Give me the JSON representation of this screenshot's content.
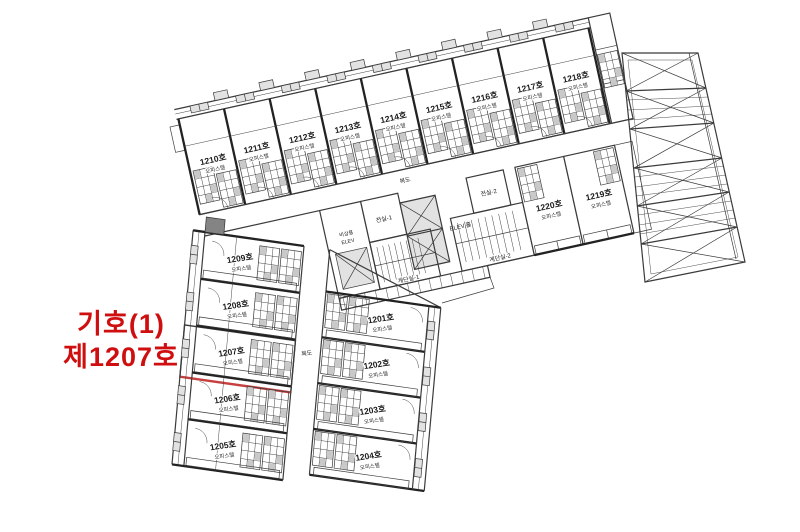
{
  "annotation": {
    "line1": "기호(1)",
    "line2": "제1207호"
  },
  "colors": {
    "annotation_red": "#cf0f0f",
    "highlight_fill": "#f3b7b7",
    "highlight_stroke": "#c64040",
    "line_color": "#3b3b3b"
  },
  "units": {
    "u1201": {
      "no": "1201호",
      "type": "오피스텔"
    },
    "u1202": {
      "no": "1202호",
      "type": "오피스텔"
    },
    "u1203": {
      "no": "1203호",
      "type": "오피스텔"
    },
    "u1204": {
      "no": "1204호",
      "type": "오피스텔"
    },
    "u1205": {
      "no": "1205호",
      "type": "오피스텔"
    },
    "u1206": {
      "no": "1206호",
      "type": "오피스텔"
    },
    "u1207": {
      "no": "1207호",
      "type": "오피스텔"
    },
    "u1208": {
      "no": "1208호",
      "type": "오피스텔"
    },
    "u1209": {
      "no": "1209호",
      "type": "오피스텔"
    },
    "u1210": {
      "no": "1210호",
      "type": "오피스텔"
    },
    "u1211": {
      "no": "1211호",
      "type": "오피스텔"
    },
    "u1212": {
      "no": "1212호",
      "type": "오피스텔"
    },
    "u1213": {
      "no": "1213호",
      "type": "오피스텔"
    },
    "u1214": {
      "no": "1214호",
      "type": "오피스텔"
    },
    "u1215": {
      "no": "1215호",
      "type": "오피스텔"
    },
    "u1216": {
      "no": "1216호",
      "type": "오피스텔"
    },
    "u1217": {
      "no": "1217호",
      "type": "오피스텔"
    },
    "u1218": {
      "no": "1218호",
      "type": "오피스텔"
    },
    "u1219": {
      "no": "1219호",
      "type": "오피스텔"
    },
    "u1220": {
      "no": "1220호",
      "type": "오피스텔"
    }
  },
  "core": {
    "corridor_upper": "복도",
    "corridor_lower": "복도",
    "vestibule1": "전실-1",
    "vestibule2": "전실-2",
    "elev_hall": "ELEV.홀",
    "emergency_elev_line1": "비상용",
    "emergency_elev_line2": "ELEV",
    "stair1": "계단실-1",
    "stair2": "계단실-2"
  }
}
